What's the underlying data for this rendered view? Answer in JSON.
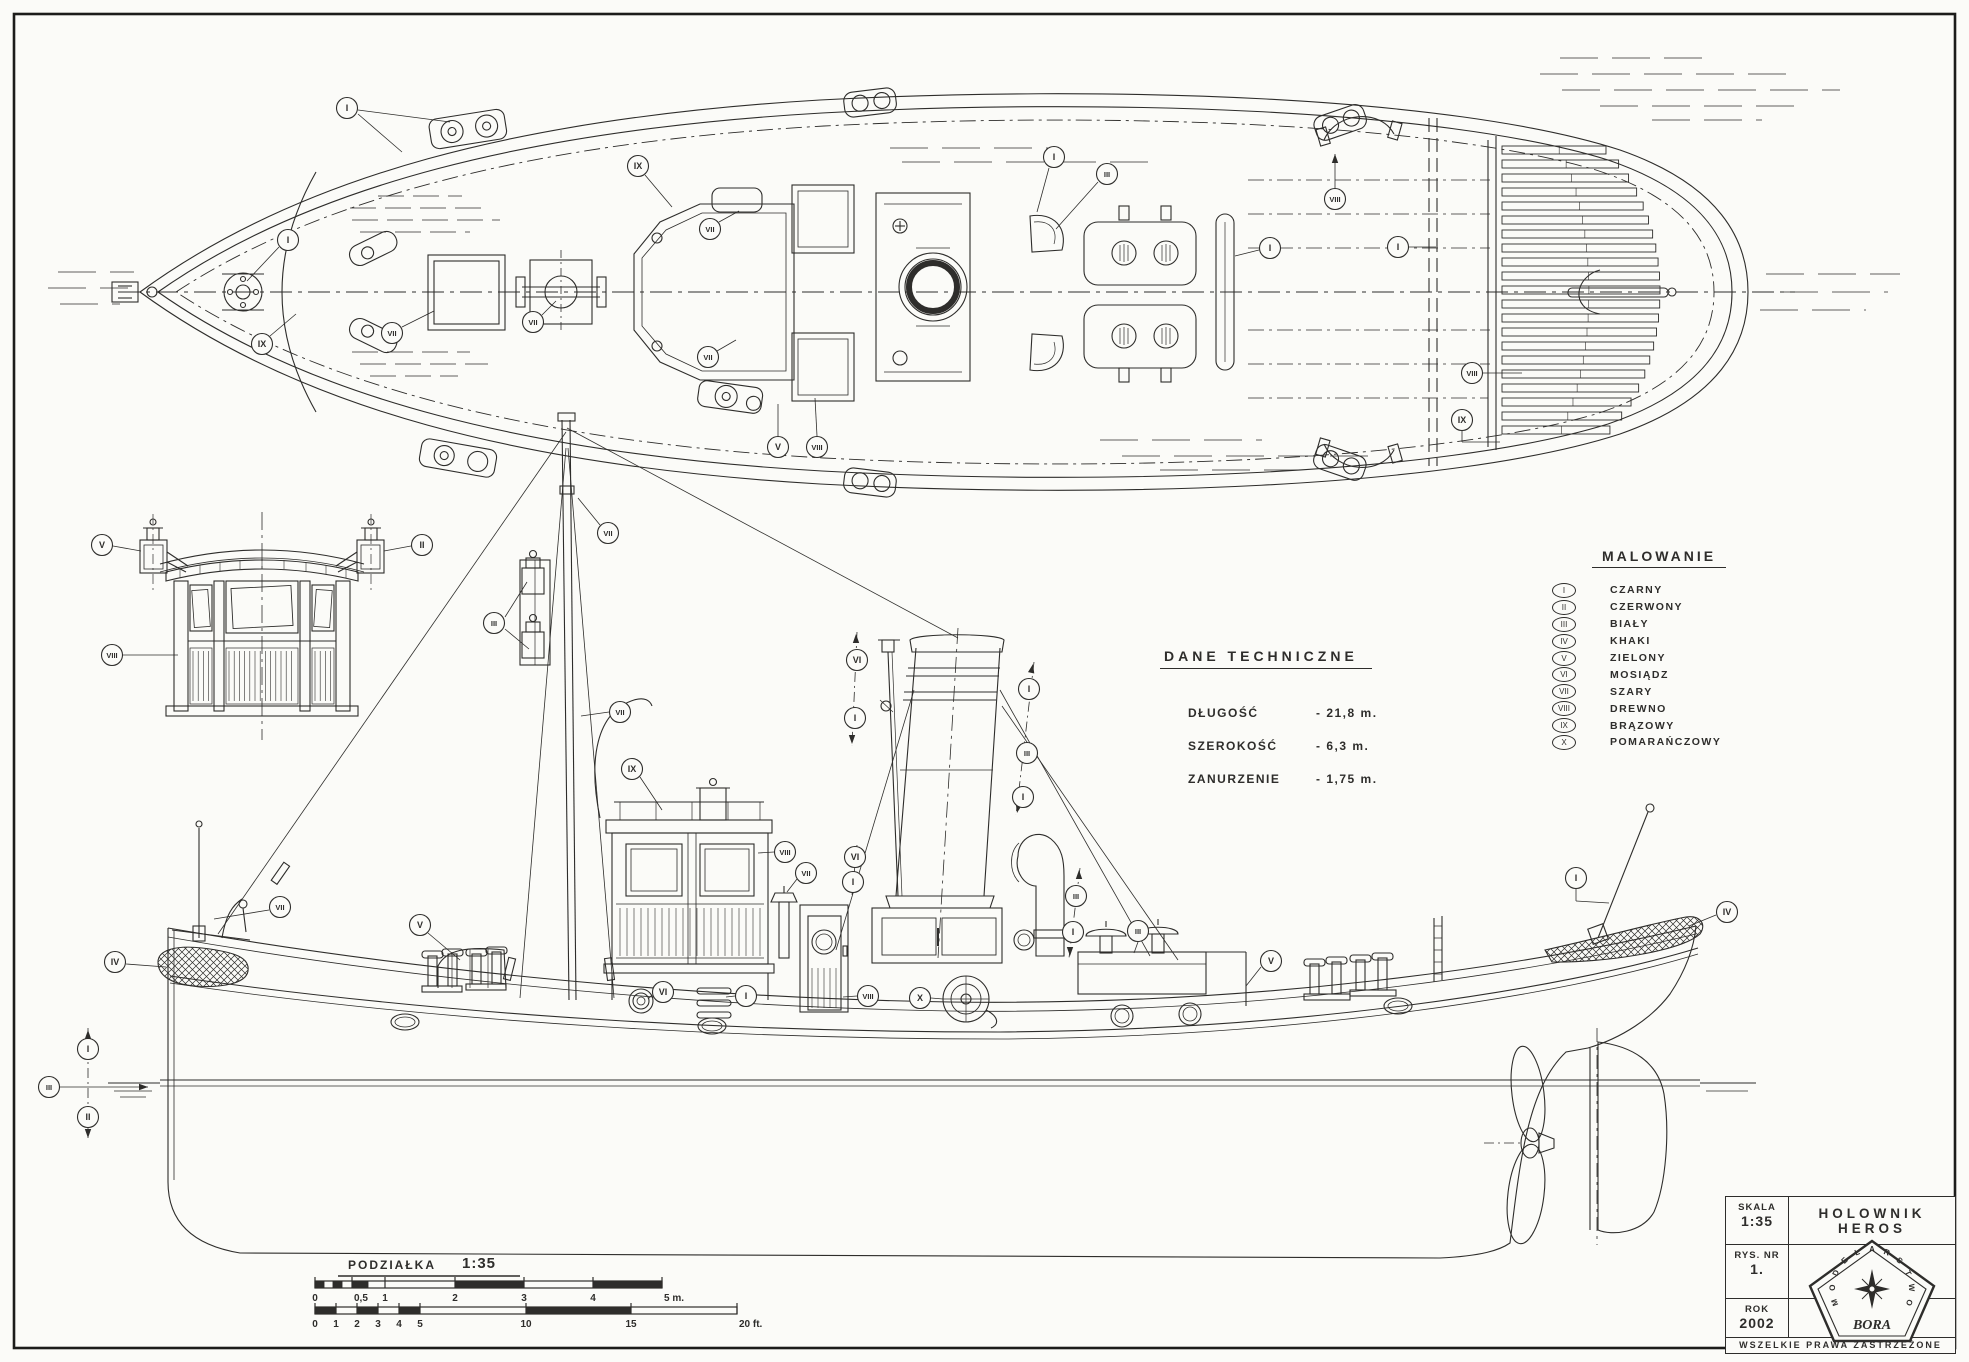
{
  "sheet": {
    "kind": "model ship blueprint",
    "ink": "#2e2d2b",
    "paper": "#fbfbf8"
  },
  "title_block": {
    "skala_label": "SKALA",
    "skala_value": "1:35",
    "rys_label": "RYS. NR",
    "rys_value": "1.",
    "rok_label": "ROK",
    "rok_value": "2002",
    "ship_name": "HOLOWNIK  HEROS",
    "rights": "WSZELKIE  PRAWA  ZASTRZEŻONE",
    "logo_name": "BORA",
    "logo_ring_text": "MODELARSTWO"
  },
  "tech_data": {
    "title": "DANE  TECHNICZNE",
    "rows": [
      {
        "label": "DŁUGOŚĆ",
        "value": "- 21,8 m."
      },
      {
        "label": "SZEROKOŚĆ",
        "value": "-  6,3 m."
      },
      {
        "label": "ZANURZENIE",
        "value": "- 1,75 m."
      }
    ]
  },
  "legend": {
    "title": "MALOWANIE",
    "items": [
      {
        "num": "I",
        "name": "CZARNY"
      },
      {
        "num": "II",
        "name": "CZERWONY"
      },
      {
        "num": "III",
        "name": "BIAŁY"
      },
      {
        "num": "IV",
        "name": "KHAKI"
      },
      {
        "num": "V",
        "name": "ZIELONY"
      },
      {
        "num": "VI",
        "name": "MOSIĄDZ"
      },
      {
        "num": "VII",
        "name": "SZARY"
      },
      {
        "num": "VIII",
        "name": "DREWNO"
      },
      {
        "num": "IX",
        "name": "BRĄZOWY"
      },
      {
        "num": "X",
        "name": "POMARAŃCZOWY"
      }
    ]
  },
  "scale_bar": {
    "title": "PODZIAŁKA",
    "ratio": "1:35",
    "meters": {
      "y": 1281,
      "h": 7,
      "ticks": [
        [
          315,
          "0"
        ],
        [
          352,
          "0,5"
        ],
        [
          385,
          "1"
        ],
        [
          455,
          "2"
        ],
        [
          524,
          "3"
        ],
        [
          593,
          "4"
        ],
        [
          662,
          "5 m."
        ]
      ],
      "subticks": [
        315,
        324,
        333,
        342,
        352,
        368,
        385
      ],
      "segments": [
        [
          385,
          455,
          0
        ],
        [
          455,
          524,
          1
        ],
        [
          524,
          593,
          0
        ],
        [
          593,
          662,
          1
        ],
        [
          315,
          324,
          1
        ],
        [
          324,
          333,
          0
        ],
        [
          333,
          342,
          1
        ],
        [
          342,
          352,
          0
        ],
        [
          352,
          368,
          1
        ],
        [
          368,
          385,
          0
        ]
      ]
    },
    "feet": {
      "y": 1307,
      "h": 7,
      "ticks": [
        [
          315,
          "0"
        ],
        [
          336,
          "1"
        ],
        [
          357,
          "2"
        ],
        [
          378,
          "3"
        ],
        [
          399,
          "4"
        ],
        [
          420,
          "5"
        ],
        [
          526,
          "10"
        ],
        [
          631,
          "15"
        ],
        [
          737,
          "20 ft."
        ]
      ],
      "subticks": [],
      "segments": [
        [
          315,
          336,
          1
        ],
        [
          336,
          357,
          0
        ],
        [
          357,
          378,
          1
        ],
        [
          378,
          399,
          0
        ],
        [
          399,
          420,
          1
        ],
        [
          420,
          526,
          0
        ],
        [
          526,
          631,
          1
        ],
        [
          631,
          737,
          0
        ]
      ]
    }
  },
  "callouts": [
    {
      "v": "plan",
      "n": "I",
      "x": 347,
      "y": 108,
      "ld": [
        [
          358,
          114,
          402,
          152
        ],
        [
          358,
          110,
          450,
          122
        ]
      ]
    },
    {
      "v": "plan",
      "n": "I",
      "x": 288,
      "y": 240,
      "ld": [
        [
          279,
          247,
          247,
          281
        ]
      ]
    },
    {
      "v": "plan",
      "n": "IX",
      "x": 262,
      "y": 344,
      "ld": [
        [
          270,
          336,
          296,
          314
        ]
      ]
    },
    {
      "v": "plan",
      "n": "VII",
      "x": 392,
      "y": 333,
      "ld": [
        [
          402,
          327,
          434,
          311
        ]
      ]
    },
    {
      "v": "plan",
      "n": "VII",
      "x": 533,
      "y": 322,
      "ld": [
        [
          542,
          315,
          556,
          301
        ]
      ]
    },
    {
      "v": "plan",
      "n": "IX",
      "x": 638,
      "y": 166,
      "ld": [
        [
          645,
          175,
          672,
          207
        ]
      ]
    },
    {
      "v": "plan",
      "n": "VII",
      "x": 710,
      "y": 229,
      "ld": [
        [
          719,
          222,
          739,
          211
        ]
      ]
    },
    {
      "v": "plan",
      "n": "VII",
      "x": 708,
      "y": 357,
      "ld": [
        [
          717,
          351,
          736,
          340
        ]
      ]
    },
    {
      "v": "plan",
      "n": "I",
      "x": 1054,
      "y": 157,
      "ld": [
        [
          1049,
          168,
          1037,
          212
        ]
      ]
    },
    {
      "v": "plan",
      "n": "III",
      "x": 1107,
      "y": 174,
      "ld": [
        [
          1098,
          182,
          1056,
          229
        ]
      ]
    },
    {
      "v": "plan",
      "n": "I",
      "x": 1270,
      "y": 248,
      "ld": [
        [
          1259,
          250,
          1235,
          256
        ]
      ]
    },
    {
      "v": "plan",
      "n": "VIII",
      "x": 1335,
      "y": 199,
      "ld": [
        [
          1335,
          188,
          1335,
          154
        ]
      ]
    },
    {
      "v": "plan",
      "n": "I",
      "x": 1398,
      "y": 247,
      "ld": [
        [
          1409,
          247,
          1436,
          247
        ]
      ]
    },
    {
      "v": "plan",
      "n": "VIII",
      "x": 1472,
      "y": 373,
      "ld": [
        [
          1483,
          373,
          1522,
          373
        ]
      ]
    },
    {
      "v": "plan",
      "n": "IX",
      "x": 1462,
      "y": 420,
      "ld": [
        [
          1462,
          431,
          1462,
          442
        ],
        [
          1462,
          442,
          1500,
          442
        ]
      ]
    },
    {
      "v": "plan",
      "n": "V",
      "x": 778,
      "y": 447,
      "ld": [
        [
          778,
          436,
          778,
          404
        ]
      ]
    },
    {
      "v": "plan",
      "n": "VIII",
      "x": 817,
      "y": 447,
      "ld": [
        [
          817,
          436,
          815,
          398
        ]
      ]
    },
    {
      "v": "front",
      "n": "V",
      "x": 102,
      "y": 545,
      "ld": [
        [
          113,
          546,
          141,
          551
        ]
      ]
    },
    {
      "v": "front",
      "n": "II",
      "x": 422,
      "y": 545,
      "ld": [
        [
          411,
          546,
          384,
          551
        ]
      ]
    },
    {
      "v": "front",
      "n": "VIII",
      "x": 112,
      "y": 655,
      "ld": [
        [
          123,
          655,
          178,
          655
        ]
      ]
    },
    {
      "v": "side",
      "n": "IV",
      "x": 115,
      "y": 962,
      "ld": [
        [
          126,
          964,
          166,
          967
        ]
      ]
    },
    {
      "v": "side",
      "n": "VII",
      "x": 280,
      "y": 907,
      "ld": [
        [
          269,
          910,
          214,
          919
        ]
      ]
    },
    {
      "v": "side",
      "n": "V",
      "x": 420,
      "y": 925,
      "ld": [
        [
          428,
          933,
          460,
          960
        ]
      ]
    },
    {
      "v": "side",
      "n": "VII",
      "x": 608,
      "y": 533,
      "ld": [
        [
          600,
          525,
          578,
          498
        ]
      ]
    },
    {
      "v": "side",
      "n": "III",
      "x": 494,
      "y": 623,
      "ld": [
        [
          505,
          617,
          527,
          582
        ],
        [
          505,
          629,
          529,
          649
        ]
      ]
    },
    {
      "v": "side",
      "n": "VII",
      "x": 620,
      "y": 712,
      "ld": [
        [
          609,
          712,
          581,
          716
        ]
      ]
    },
    {
      "v": "side",
      "n": "IX",
      "x": 632,
      "y": 769,
      "ld": [
        [
          640,
          777,
          662,
          810
        ]
      ]
    },
    {
      "v": "side",
      "n": "VIII",
      "x": 785,
      "y": 852,
      "ld": [
        [
          774,
          852,
          758,
          853
        ]
      ]
    },
    {
      "v": "side",
      "n": "VII",
      "x": 806,
      "y": 873,
      "ld": [
        [
          797,
          879,
          787,
          892
        ]
      ]
    },
    {
      "v": "side",
      "n": "VI",
      "x": 857,
      "y": 660,
      "ld": []
    },
    {
      "v": "side",
      "n": "I",
      "x": 855,
      "y": 718,
      "ld": []
    },
    {
      "v": "side",
      "n": "VI",
      "x": 855,
      "y": 857,
      "ld": []
    },
    {
      "v": "side",
      "n": "I",
      "x": 853,
      "y": 882,
      "ld": []
    },
    {
      "v": "side",
      "n": "I",
      "x": 1029,
      "y": 689,
      "ld": []
    },
    {
      "v": "side",
      "n": "III",
      "x": 1027,
      "y": 753,
      "ld": []
    },
    {
      "v": "side",
      "n": "I",
      "x": 1023,
      "y": 797,
      "ld": []
    },
    {
      "v": "side",
      "n": "III",
      "x": 1076,
      "y": 896,
      "ld": []
    },
    {
      "v": "side",
      "n": "I",
      "x": 1073,
      "y": 932,
      "ld": []
    },
    {
      "v": "side",
      "n": "III",
      "x": 1138,
      "y": 931,
      "ld": [
        [
          1138,
          942,
          1134,
          953
        ]
      ]
    },
    {
      "v": "side",
      "n": "V",
      "x": 1271,
      "y": 961,
      "ld": [
        [
          1261,
          967,
          1246,
          986
        ]
      ]
    },
    {
      "v": "side",
      "n": "X",
      "x": 920,
      "y": 998,
      "ld": [
        [
          931,
          998,
          943,
          999
        ]
      ]
    },
    {
      "v": "side",
      "n": "VIII",
      "x": 868,
      "y": 996,
      "ld": [
        [
          857,
          996,
          843,
          997
        ]
      ]
    },
    {
      "v": "side",
      "n": "I",
      "x": 746,
      "y": 996,
      "ld": [
        [
          735,
          996,
          726,
          997
        ]
      ]
    },
    {
      "v": "side",
      "n": "VI",
      "x": 663,
      "y": 992,
      "ld": [
        [
          652,
          995,
          648,
          999
        ]
      ]
    },
    {
      "v": "side",
      "n": "I",
      "x": 1576,
      "y": 878,
      "ld": [
        [
          1576,
          889,
          1576,
          901
        ],
        [
          1576,
          901,
          1609,
          903
        ]
      ]
    },
    {
      "v": "side",
      "n": "IV",
      "x": 1727,
      "y": 912,
      "ld": [
        [
          1716,
          915,
          1689,
          926
        ]
      ]
    },
    {
      "v": "side",
      "n": "I",
      "x": 88,
      "y": 1049,
      "ld": []
    },
    {
      "v": "side",
      "n": "III",
      "x": 49,
      "y": 1087,
      "ld": [
        [
          60,
          1087,
          148,
          1087
        ]
      ]
    },
    {
      "v": "side",
      "n": "II",
      "x": 88,
      "y": 1117,
      "ld": []
    }
  ],
  "callout_axes": [
    [
      857,
      632,
      852,
      746
    ],
    [
      857,
      845,
      852,
      895
    ],
    [
      1034,
      662,
      1016,
      815
    ],
    [
      1080,
      868,
      1069,
      958
    ],
    [
      88,
      1028,
      88,
      1140
    ]
  ],
  "callout_arrows": [
    [
      1335,
      154,
      270
    ],
    [
      148,
      1087,
      0
    ],
    [
      88,
      1030,
      270
    ],
    [
      88,
      1138,
      90
    ],
    [
      856,
      634,
      270
    ],
    [
      852,
      744,
      90
    ],
    [
      857,
      847,
      270
    ],
    [
      852,
      893,
      90
    ],
    [
      1033,
      664,
      282
    ],
    [
      1017,
      813,
      102
    ],
    [
      1079,
      870,
      270
    ],
    [
      1070,
      956,
      90
    ]
  ]
}
